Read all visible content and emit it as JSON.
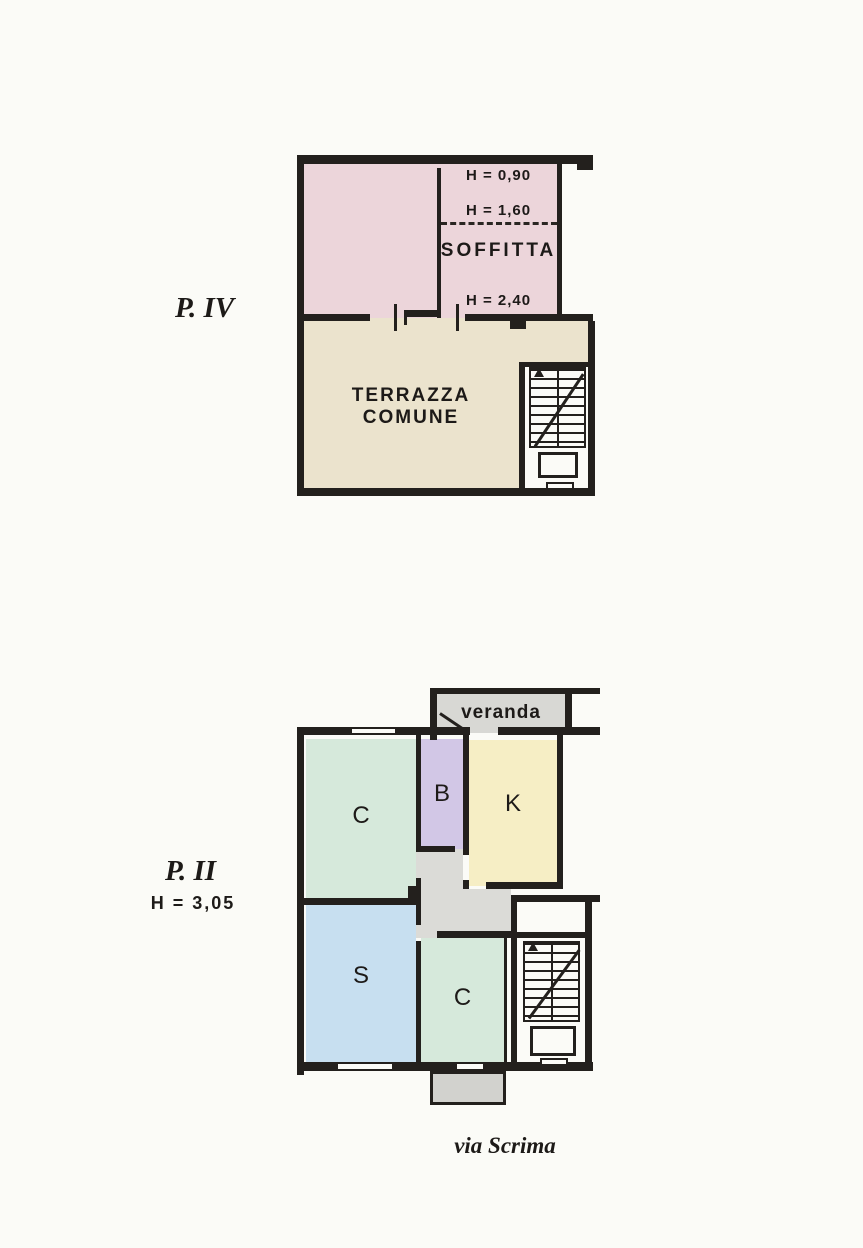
{
  "page": {
    "street_label": "via Scrima"
  },
  "colors": {
    "wall": "#23201d",
    "attic_pink": "#ecd5da",
    "terrace_beige": "#ebe3cd",
    "veranda_gray": "#d8d8d4",
    "hall_gray": "#dbdbd7",
    "balcony_gray": "#d2d2ce",
    "room_green": "#d6e9db",
    "room_lavender": "#d2c7e6",
    "room_yellow": "#f6eec5",
    "room_blue": "#c7dff0"
  },
  "plan_upper": {
    "floor_label": "P. IV",
    "attic_room": {
      "label": "SOFFITTA",
      "height_top": "H = 0,90",
      "height_mid": "H = 1,60",
      "height_bottom": "H = 2,40"
    },
    "terrace": {
      "label": "TERRAZZA COMUNE"
    }
  },
  "plan_lower": {
    "floor_label": "P. II",
    "ceiling_height": "H = 3,05",
    "veranda": {
      "label": "veranda"
    },
    "rooms": [
      {
        "id": "C-upper",
        "label": "C"
      },
      {
        "id": "B",
        "label": "B"
      },
      {
        "id": "K",
        "label": "K"
      },
      {
        "id": "S",
        "label": "S"
      },
      {
        "id": "C-lower",
        "label": "C"
      }
    ]
  }
}
